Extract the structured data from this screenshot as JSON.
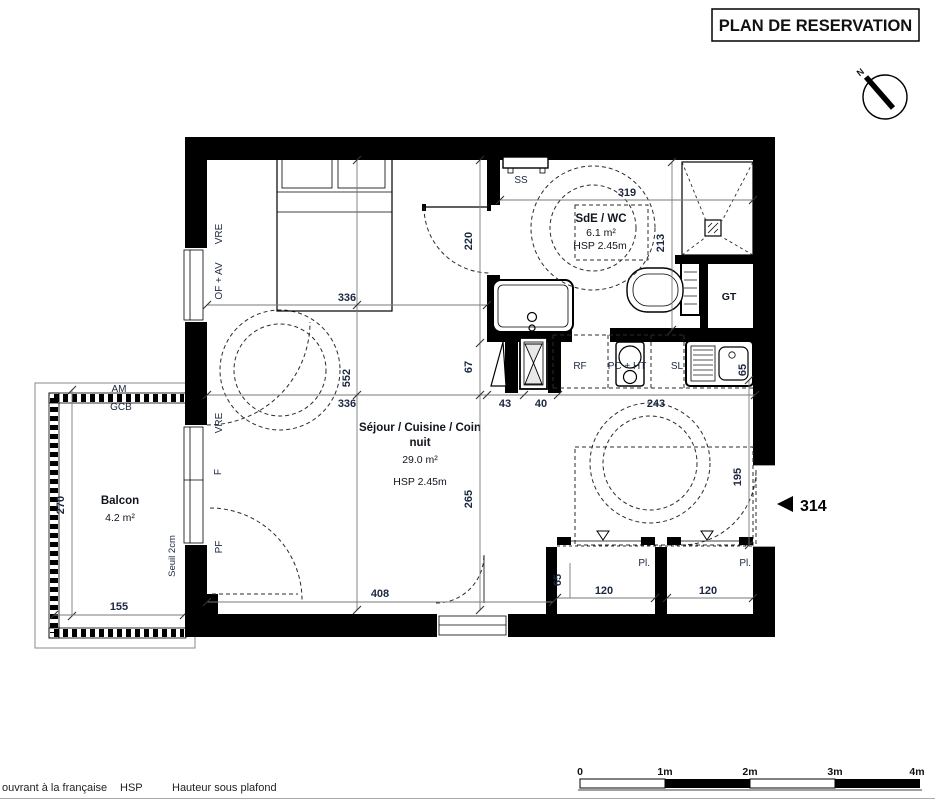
{
  "title": "PLAN DE RESERVATION",
  "north_label": "N",
  "unit_marker": "314",
  "rooms": {
    "sejour": {
      "name_line1": "Séjour / Cuisine / Coin",
      "name_line2": "nuit",
      "area": "29.0 m²",
      "ceiling_height": "HSP 2.45m"
    },
    "sde_wc": {
      "name": "SdE / WC",
      "area": "6.1 m²",
      "ceiling_height": "HSP 2.45m"
    },
    "balcon": {
      "name": "Balcon",
      "area": "4.2 m²"
    },
    "gaine_technique": "GT"
  },
  "fixtures": {
    "towel_rail": "SS",
    "fridge": "RF",
    "cooktop_hood": "PC + HT",
    "sl": "SL",
    "closet_left": "Pl.",
    "closet_right": "Pl."
  },
  "openings": {
    "vre_top": "VRE",
    "of_av": "OF + AV",
    "vre_mid": "VRE",
    "fixed": "F",
    "pf": "PF",
    "threshold": "Seuil 2cm",
    "am": "AM",
    "gcb": "GCB"
  },
  "dimensions": {
    "bedroom_width": "336",
    "room_depth": "552",
    "sejour_width": "336",
    "kitchen_43": "43",
    "kitchen_40": "40",
    "kitchen_243": "243",
    "hall_depth": "220",
    "hall_67": "67",
    "sejour_265": "265",
    "sde_width": "319",
    "sde_depth": "213",
    "sink_65": "65",
    "entry_195": "195",
    "bottom_width": "408",
    "closet_depth_65": "65",
    "closet1_width": "120",
    "closet2_width": "120",
    "balcony_depth": "270",
    "balcony_width": "155"
  },
  "scale_bar": {
    "t0": "0",
    "t1": "1m",
    "t2": "2m",
    "t3": "3m",
    "t4": "4m"
  },
  "legend": {
    "ouvrant": "ouvrant à la française",
    "hsp_abbr": "HSP",
    "hsp_full": "Hauteur sous plafond"
  }
}
